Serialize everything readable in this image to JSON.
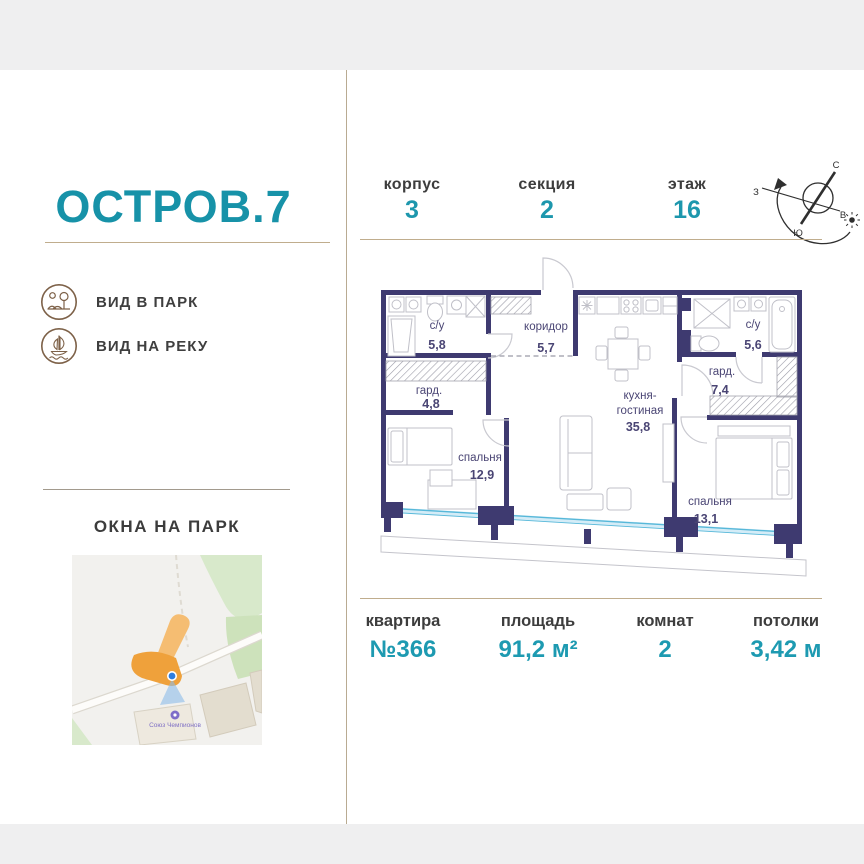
{
  "brand": {
    "logo": "ОСТРОВ.7",
    "features": [
      {
        "label": "ВИД В ПАРК",
        "icon": "park-view-icon"
      },
      {
        "label": "ВИД НА РЕКУ",
        "icon": "river-view-icon"
      }
    ],
    "windows_title": "ОКНА НА ПАРК",
    "map_poi_label": "Союз Чемпионов"
  },
  "header": {
    "blocks": [
      {
        "label": "корпус",
        "value": "3"
      },
      {
        "label": "секция",
        "value": "2"
      },
      {
        "label": "этаж",
        "value": "16"
      }
    ],
    "compass": {
      "north": "С",
      "south": "Ю",
      "west": "З",
      "east": "В"
    }
  },
  "plan": {
    "rooms": {
      "bath1": {
        "name": "с/у",
        "area": "5,8"
      },
      "corridor": {
        "name": "коридор",
        "area": "5,7"
      },
      "ward1": {
        "name": "гард.",
        "area": "4,8"
      },
      "bed1": {
        "name": "спальня",
        "area": "12,9"
      },
      "kitchen": {
        "name1": "кухня-",
        "name2": "гостиная",
        "area": "35,8"
      },
      "bath2": {
        "name": "с/у",
        "area": "5,6"
      },
      "ward2": {
        "name": "гард.",
        "area": "7,4"
      },
      "bed2": {
        "name": "спальня",
        "area": "13,1"
      }
    }
  },
  "stats": [
    {
      "label": "квартира",
      "value": "№366"
    },
    {
      "label": "площадь",
      "value": "91,2 м²"
    },
    {
      "label": "комнат",
      "value": "2"
    },
    {
      "label": "потолки",
      "value": "3,42 м"
    }
  ],
  "colors": {
    "accent": "#1d97ad",
    "wall": "#3e3a70",
    "tan_line": "#c0ad8d",
    "glazing": "#57b8d9",
    "map_building_orange": "#efa13b"
  }
}
